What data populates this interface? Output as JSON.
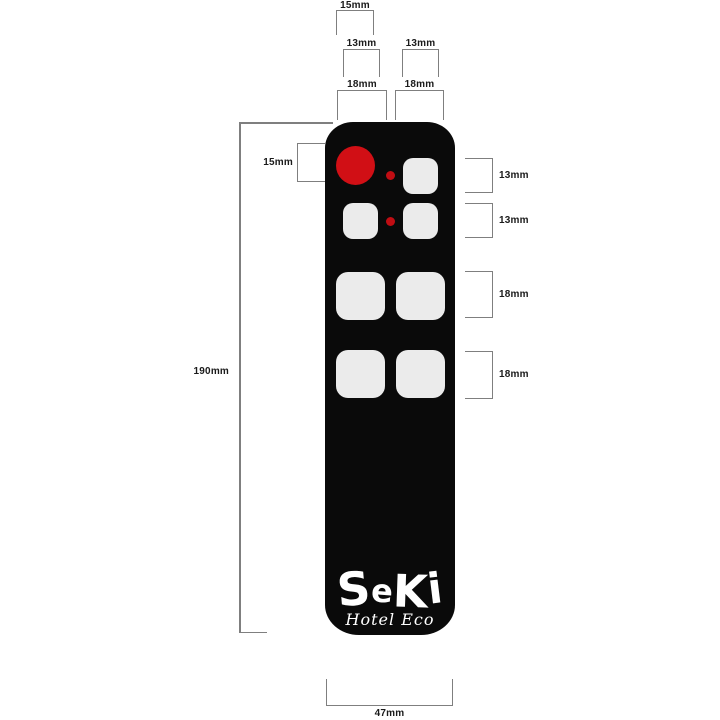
{
  "figure": {
    "description": "Dimension diagram of SeKi Hotel Eco remote control",
    "background": "#ffffff"
  },
  "colors": {
    "remote_body": "#0a0a0a",
    "accent_red": "#d10f15",
    "button_fill": "#ebebeb",
    "dimension_line": "#7f7f7f",
    "label_text": "#1a1a1a",
    "logo_text": "#ffffff"
  },
  "dims": {
    "top_15": "15mm",
    "top_13_left": "13mm",
    "top_13_right": "13mm",
    "top_18_left": "18mm",
    "top_18_right": "18mm",
    "left_15": "15mm",
    "left_190": "190mm",
    "right_13_a": "13mm",
    "right_13_b": "13mm",
    "right_18_a": "18mm",
    "right_18_b": "18mm",
    "bottom_47": "47mm"
  },
  "logo": {
    "brand": "SeKi",
    "letters": [
      "S",
      "e",
      "K",
      "i"
    ],
    "subtitle": "Hotel Eco"
  }
}
